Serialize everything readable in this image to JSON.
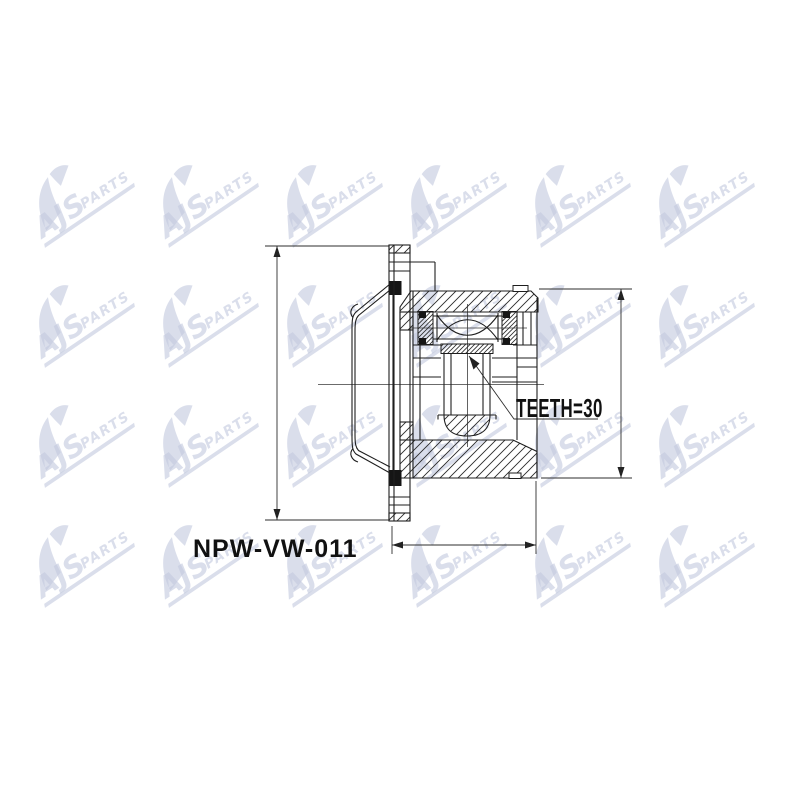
{
  "watermark": {
    "brand_top": "AJS",
    "brand_bottom": "PARTS",
    "color": "#c4cade",
    "opacity": 0.62,
    "rows": 4,
    "cols": 6
  },
  "labels": {
    "part_number": "NPW-VW-011",
    "teeth": "TEETH=30"
  },
  "colors": {
    "background": "#ffffff",
    "line": "#1e1e1e",
    "dim": "#2e2e2e",
    "black_fill": "#151515"
  }
}
